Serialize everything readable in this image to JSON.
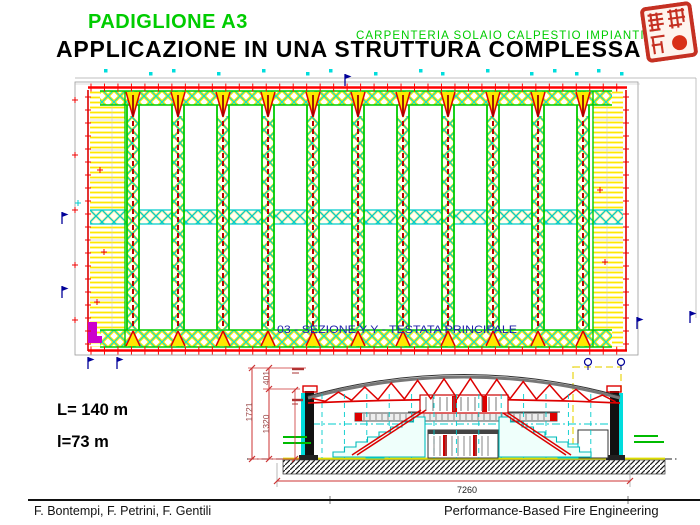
{
  "header": {
    "pavilion_title": "PADIGLIONE A3",
    "subtitle": "CARPENTERIA SOLAIO CALPESTIO IMPIANTI",
    "main_title": "APPLICAZIONE IN UNA STRUTTURA COMPLESSA"
  },
  "stamp": {
    "icon": "chinese-seal-stamp",
    "color": "#C53022"
  },
  "plan": {
    "caption": "03 - SEZIONE Y-Y - TESTATA PRINCIPALE",
    "truss_count": 11
  },
  "section": {
    "dims": {
      "upper_height": "401",
      "lower_height": "1320",
      "overall_height": "1721",
      "overall_width": "7260"
    }
  },
  "labels": {
    "length": "L= 140 m",
    "width": "l=73 m"
  },
  "footer": {
    "authors": "F. Bontempi, F. Petrini, F. Gentili",
    "brand": "Performance-Based Fire Engineering"
  },
  "colors": {
    "green": "#00CC00",
    "yellow": "#FFE800",
    "cyan": "#00CCCC",
    "red": "#FF0000",
    "dark_red": "#CC0000",
    "navy": "#000099",
    "magenta": "#CC00CC",
    "caption_blue": "#2222AA",
    "dim_maroon": "#994444",
    "seal_red": "#C53022"
  }
}
